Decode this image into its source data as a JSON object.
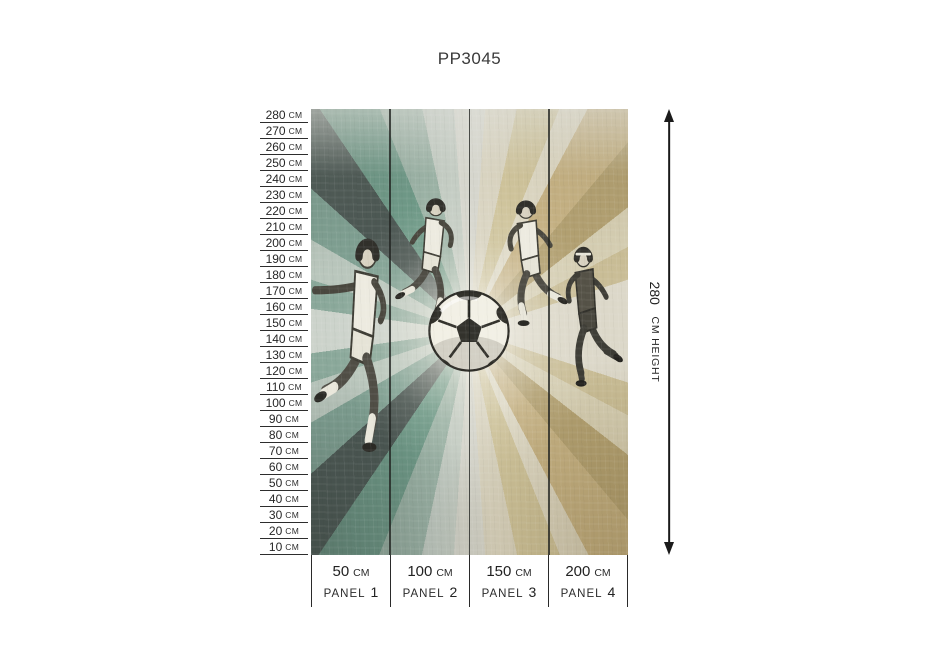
{
  "title": "PP3045",
  "ruler": {
    "unit": "CM",
    "values": [
      "280",
      "270",
      "260",
      "250",
      "240",
      "230",
      "220",
      "210",
      "200",
      "190",
      "180",
      "170",
      "160",
      "150",
      "140",
      "130",
      "120",
      "110",
      "100",
      "90",
      "80",
      "70",
      "60",
      "50",
      "40",
      "30",
      "20",
      "10"
    ]
  },
  "mural": {
    "subject": "Four sketched soccer players and a soccer ball over a grunge ray-burst background",
    "panel_count": 4,
    "colors": {
      "teal_ray": "#6f9a88",
      "dark_slate_ray": "#4b5652",
      "pale_teal_ray": "#b9c6bc",
      "tan_ray": "#c6b284",
      "dark_tan_ray": "#b2a071",
      "khaki_ray": "#cfc49c",
      "base_light": "#dcdad1",
      "sketch_ink": "#3e3d35"
    }
  },
  "panels": {
    "unit": "CM",
    "word": "PANEL",
    "items": [
      {
        "width": "50",
        "number": "1"
      },
      {
        "width": "100",
        "number": "2"
      },
      {
        "width": "150",
        "number": "3"
      },
      {
        "width": "200",
        "number": "4"
      }
    ]
  },
  "height_indicator": {
    "value": "280",
    "unit_label": "CM HEIGHT"
  }
}
